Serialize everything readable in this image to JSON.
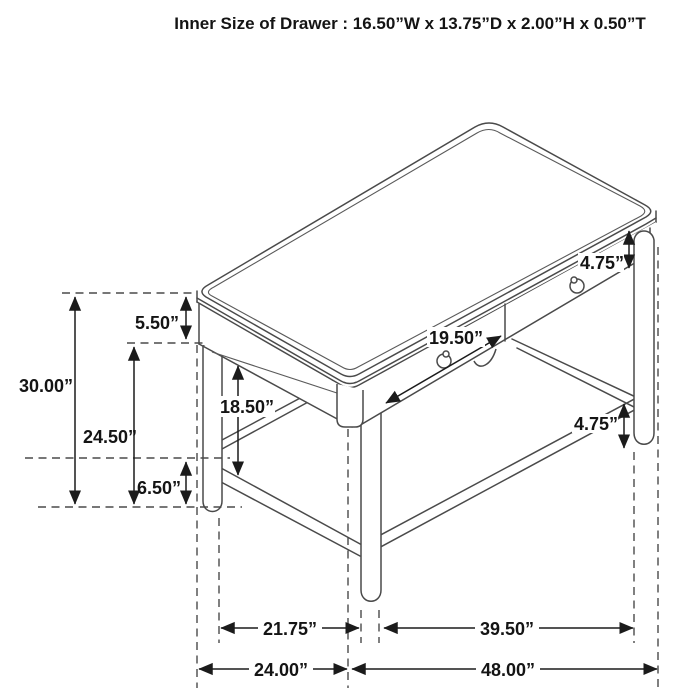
{
  "title": "Inner Size of Drawer : 16.50”W x 13.75”D x 2.00”H x 0.50”T",
  "figure": {
    "subject": "isometric line drawing of a writing desk with two front drawers, round legs and stretchers",
    "colors": {
      "background": "#ffffff",
      "line": "#4a4a4a",
      "dimension": "#1a1a1a"
    }
  },
  "dims": {
    "overall_height": "30.00”",
    "top_to_apron_bottom": "5.50”",
    "apron_bottom_to_floor": "24.50”",
    "stretcher_to_floor": "6.50”",
    "knee_clearance_height": "18.50”",
    "knee_opening_width": "19.50”",
    "drawer_face_height": "4.75”",
    "stretcher_to_leg_end": "4.75”",
    "side_leg_spacing": "21.75”",
    "front_leg_spacing": "39.50”",
    "overall_depth": "24.00”",
    "overall_width": "48.00”"
  }
}
